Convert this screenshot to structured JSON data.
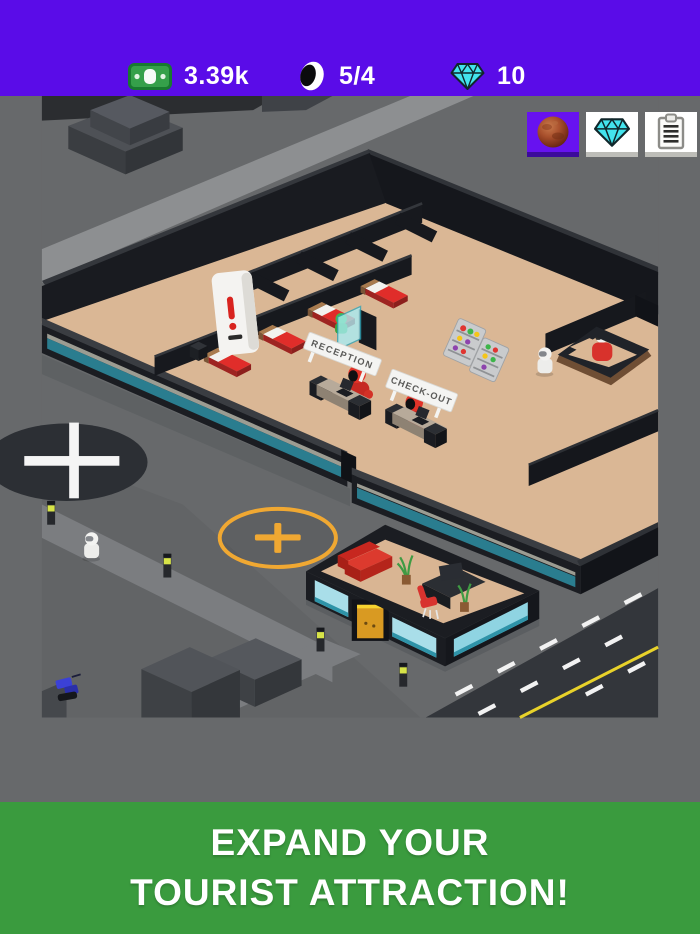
{
  "header": {
    "money": {
      "icon": "cash-icon",
      "value": "3.39k"
    },
    "capacity": {
      "icon": "astronaut-helmet-icon",
      "value": "5/4"
    },
    "gems": {
      "icon": "diamond-icon",
      "value": "10"
    }
  },
  "quick_buttons": [
    {
      "name": "planet-button",
      "icon": "mars-planet-icon"
    },
    {
      "name": "gems-button",
      "icon": "diamond-icon"
    },
    {
      "name": "orders-button",
      "icon": "clipboard-icon"
    }
  ],
  "scene": {
    "signs": {
      "reception": "RECEPTION",
      "checkout": "CHECK-OUT"
    },
    "hotel": {
      "beds": 4,
      "workers": 2,
      "bartenders": 1,
      "robots": 2,
      "vending_machines": 1
    },
    "build_spots": {
      "helipad_plus_color": "#FFFFFF",
      "expand_plus_color": "#F0A832"
    }
  },
  "banner": {
    "line1": "EXPAND YOUR",
    "line2": "TOURIST ATTRACTION!"
  },
  "colors": {
    "header_bg": "#5A0CE8",
    "banner_bg": "#3A9B3E",
    "accent_yellow": "#F0A832",
    "floor_tan": "#DAB795",
    "wall_black": "#17191E",
    "glass_teal": "#2A7D8F",
    "gem_cyan": "#43E4ED",
    "cash_green": "#35A04A",
    "road_asphalt": "#33363B",
    "worker_red": "#D8322C",
    "banner_text": "#FFFFFF"
  }
}
